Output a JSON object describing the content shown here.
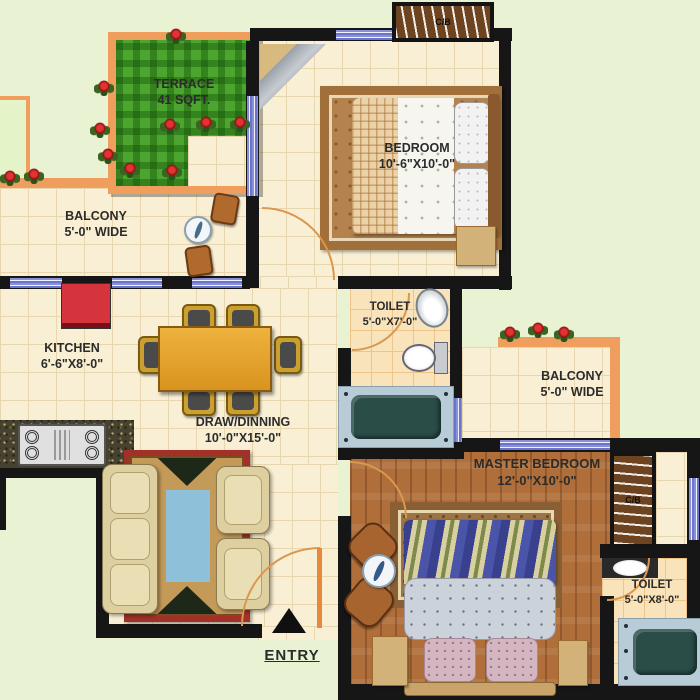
{
  "rooms": {
    "terrace": {
      "name": "TERRACE",
      "dims": "41 SQFT."
    },
    "balcony_left": {
      "name": "BALCONY",
      "dims": "5'-0\" WIDE"
    },
    "bedroom": {
      "name": "BEDROOM",
      "dims": "10'-6\"X10'-0\""
    },
    "toilet_mid": {
      "name": "TOILET",
      "dims": "5'-0\"X7'-0\""
    },
    "kitchen": {
      "name": "KITCHEN",
      "dims": "6'-6\"X8'-0\""
    },
    "draw_dining": {
      "name": "DRAW/DINNING",
      "dims": "10'-0\"X15'-0\""
    },
    "balcony_right": {
      "name": "BALCONY",
      "dims": "5'-0\" WIDE"
    },
    "master_bedroom": {
      "name": "MASTER BEDROOM",
      "dims": "12'-0\"X10'-0\""
    },
    "toilet_right": {
      "name": "TOILET",
      "dims": "5'-0\"X8'-0\""
    }
  },
  "labels": {
    "entry": "ENTRY",
    "cupboard_top": "C/B",
    "cupboard_master": "C/B"
  },
  "icons": {
    "entry_arrow": "up-triangle",
    "rose": "red-rose-plant",
    "door_swing": "quarter-arc"
  },
  "colors": {
    "background": "#e9f3d3",
    "wall": "#161616",
    "tile_floor": "#f9efd5",
    "toilet_tile": "#f9e3ba",
    "terrace_grass": "#4ca52e",
    "border_orange": "#ef9e5e",
    "window_blue": "#7d88d6",
    "wood_floor": "#b06f3a",
    "carpet_red": "#a03028",
    "fridge_red": "#d5343c",
    "bathtub_teal": "#2a4d48",
    "dining_gold": "#caa030"
  }
}
